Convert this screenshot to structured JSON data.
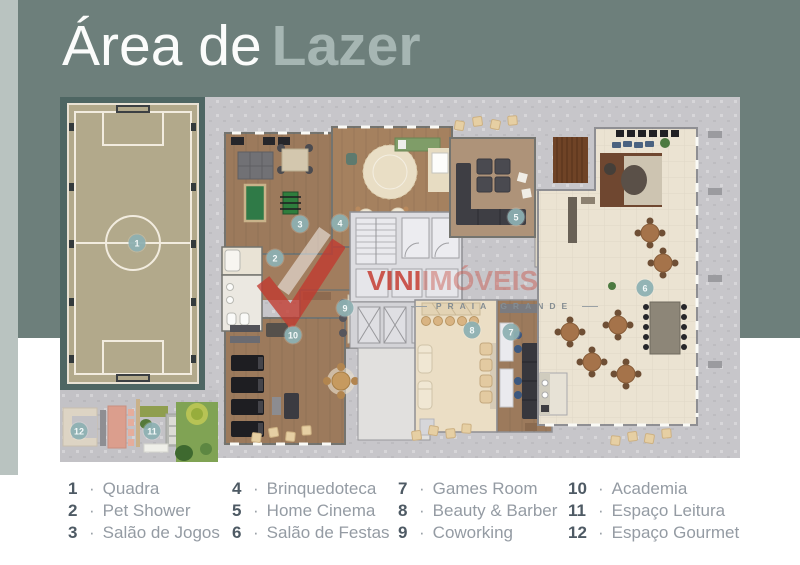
{
  "title": {
    "light": "Área de",
    "bold": "Lazer"
  },
  "watermark": {
    "brand_primary": "VINI",
    "brand_secondary": "IMÓVEIS",
    "subtitle": "PRAIA GRANDE"
  },
  "plan": {
    "markers": [
      "1",
      "2",
      "3",
      "4",
      "5",
      "6",
      "7",
      "8",
      "9",
      "10",
      "11",
      "12"
    ]
  },
  "legend": {
    "separator": "·",
    "items": [
      {
        "n": "1",
        "label": "Quadra"
      },
      {
        "n": "2",
        "label": "Pet Shower"
      },
      {
        "n": "3",
        "label": "Salão de Jogos"
      },
      {
        "n": "4",
        "label": "Brinquedoteca"
      },
      {
        "n": "5",
        "label": "Home Cinema"
      },
      {
        "n": "6",
        "label": "Salão de Festas"
      },
      {
        "n": "7",
        "label": "Games Room"
      },
      {
        "n": "8",
        "label": "Beauty & Barber"
      },
      {
        "n": "9",
        "label": "Coworking"
      },
      {
        "n": "10",
        "label": "Academia"
      },
      {
        "n": "11",
        "label": "Espaço Leitura"
      },
      {
        "n": "12",
        "label": "Espaço Gourmet"
      }
    ]
  },
  "colors": {
    "panel_teal": "#6d7f7b",
    "accent_strip": "#b9c3c0",
    "title_light": "#fbfcfb",
    "title_bold": "#a6b6b3",
    "marker_teal": "#8db0b3",
    "watermark_red": "#c43c32",
    "quadra_background": "#4e6663",
    "field_tan": "#b2a98b",
    "concrete": "#c7c6ca",
    "wood_floor": "#9c7a5c",
    "party_floor": "#ebe3d2"
  }
}
